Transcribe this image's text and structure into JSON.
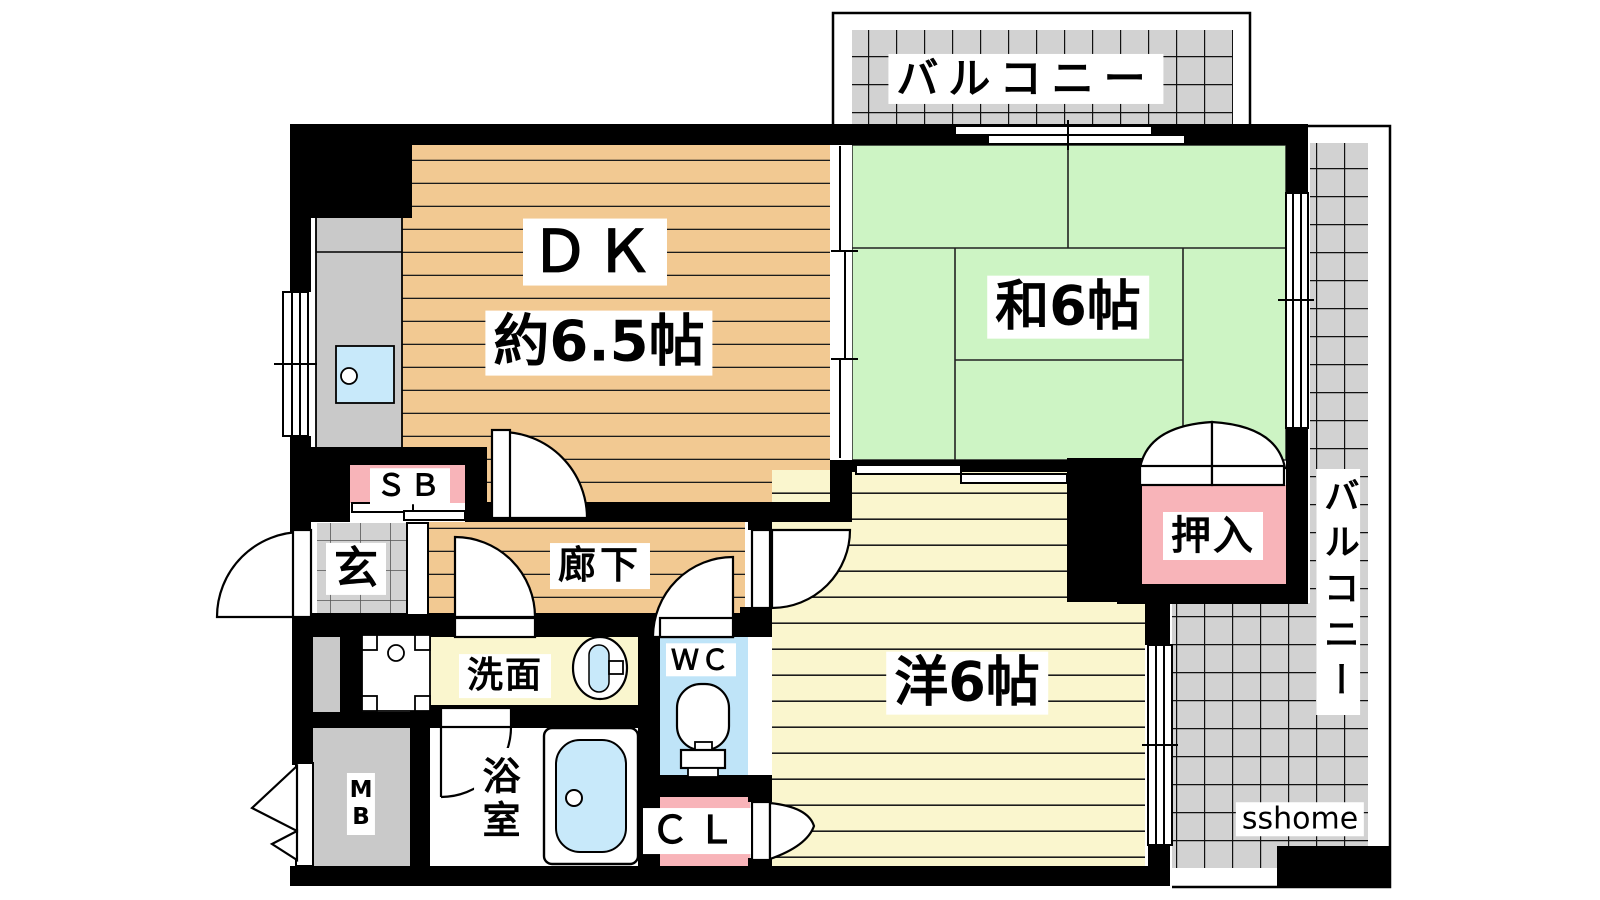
{
  "plan": {
    "rooms": {
      "dk": {
        "abbr": "ＤＫ",
        "size": "約6.5帖"
      },
      "washitsu": {
        "label": "和6帖"
      },
      "youshitsu": {
        "label": "洋6帖"
      },
      "oshiire": {
        "label": "押入"
      },
      "rouka": {
        "label": "廊下"
      },
      "genkan": {
        "label": "玄"
      },
      "shoebox": {
        "label": "ＳＢ"
      },
      "senmen": {
        "label": "洗面"
      },
      "wc": {
        "label": "ＷＣ"
      },
      "bath": {
        "label": "浴室"
      },
      "closet": {
        "label": "ＣＬ"
      },
      "meterbox": {
        "label": "MB"
      }
    },
    "balconies": {
      "top": {
        "label": "バルコニー"
      },
      "right": {
        "label": "バルコニー"
      }
    },
    "watermark": {
      "text": "sshome"
    },
    "colors": {
      "wood_dk": "#F2C992",
      "tatami_green": "#CDF4C4",
      "wood_yo": "#FAF6CE",
      "closet_pink": "#F8B4B9",
      "wc_blue": "#BFE4F8",
      "water_blue": "#C8E9FA",
      "counter_gray": "#C9C9C9",
      "balcony_gray": "#D2D2D2",
      "wall_black": "#000000"
    }
  }
}
